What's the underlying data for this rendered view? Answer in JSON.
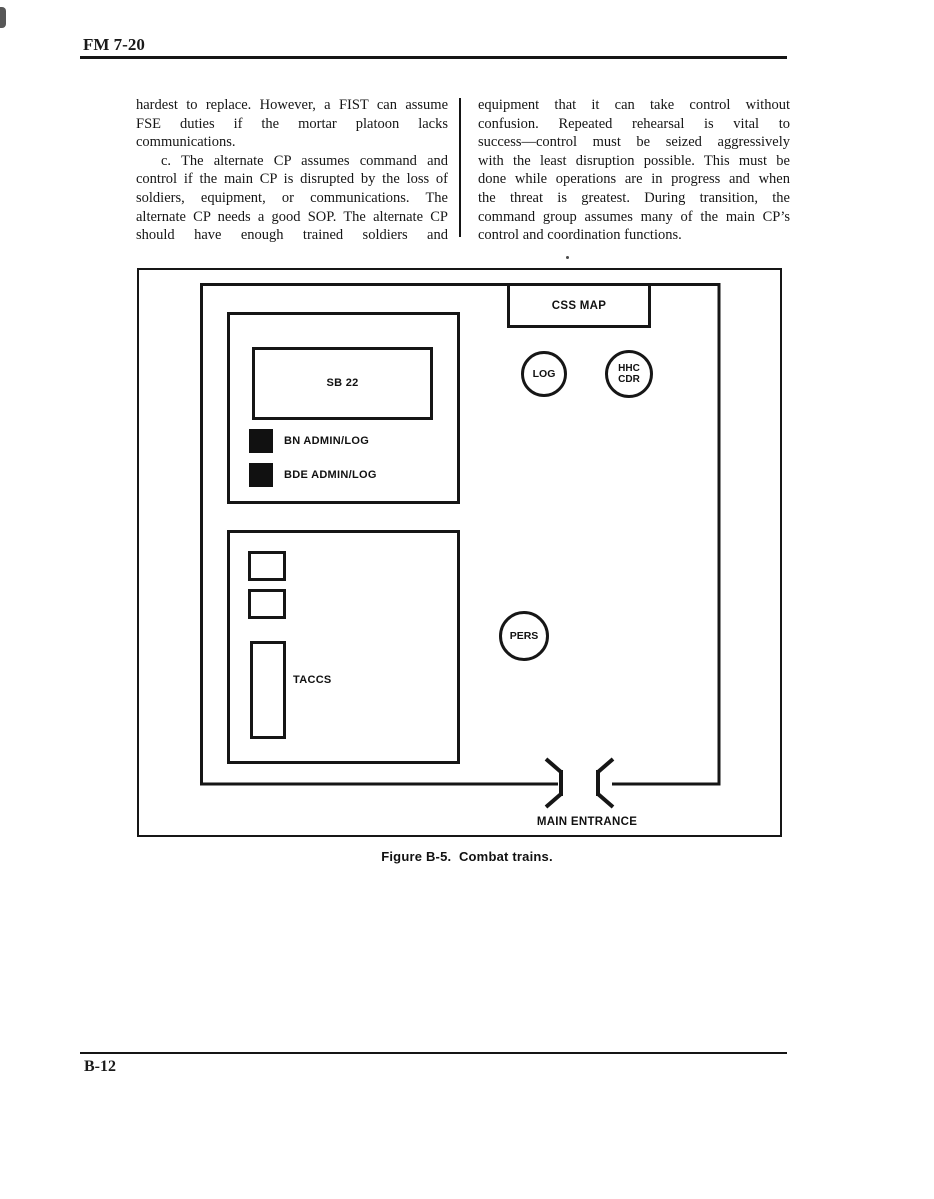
{
  "header": {
    "title": "FM 7-20"
  },
  "footer": {
    "page_number": "B-12"
  },
  "body": {
    "left_column": {
      "lines": [
        {
          "t": "hardest to replace. However, a FIST can assume",
          "j": true
        },
        {
          "t": "FSE duties if the mortar platoon lacks",
          "j": true
        },
        {
          "t": "communications.",
          "j": false
        },
        {
          "t": "c. The alternate CP assumes command and",
          "j": true,
          "indent": true
        },
        {
          "t": "control if the main CP is disrupted by the loss of",
          "j": true
        },
        {
          "t": "soldiers, equipment, or communications. The",
          "j": true
        },
        {
          "t": "alternate CP needs a good SOP. The alternate CP",
          "j": true
        },
        {
          "t": "should have enough trained soldiers and",
          "j": true
        }
      ]
    },
    "right_column": {
      "lines": [
        {
          "t": "equipment that it can take control without",
          "j": true
        },
        {
          "t": "confusion. Repeated rehearsal is vital to",
          "j": true
        },
        {
          "t": "success—control must be seized aggressively",
          "j": true
        },
        {
          "t": "with the least disruption possible. This must be",
          "j": true
        },
        {
          "t": "done while operations are in progress and when",
          "j": true
        },
        {
          "t": "the threat is greatest. During transition, the",
          "j": true
        },
        {
          "t": "command group assumes many of the main CP’s",
          "j": true
        },
        {
          "t": "control and coordination functions.",
          "j": false
        }
      ]
    }
  },
  "figure": {
    "caption": "Figure B-5.  Combat trains.",
    "labels": {
      "css_map": "CSS MAP",
      "sb22": "SB 22",
      "bn_admin_log": "BN ADMIN/LOG",
      "bde_admin_log": "BDE ADMIN/LOG",
      "taccs": "TACCS",
      "log": "LOG",
      "hhc_line1": "HHC",
      "hhc_line2": "CDR",
      "pers": "PERS",
      "main_entrance": "MAIN ENTRANCE"
    }
  },
  "colors": {
    "ink": "#161616",
    "paper": "#ffffff"
  }
}
